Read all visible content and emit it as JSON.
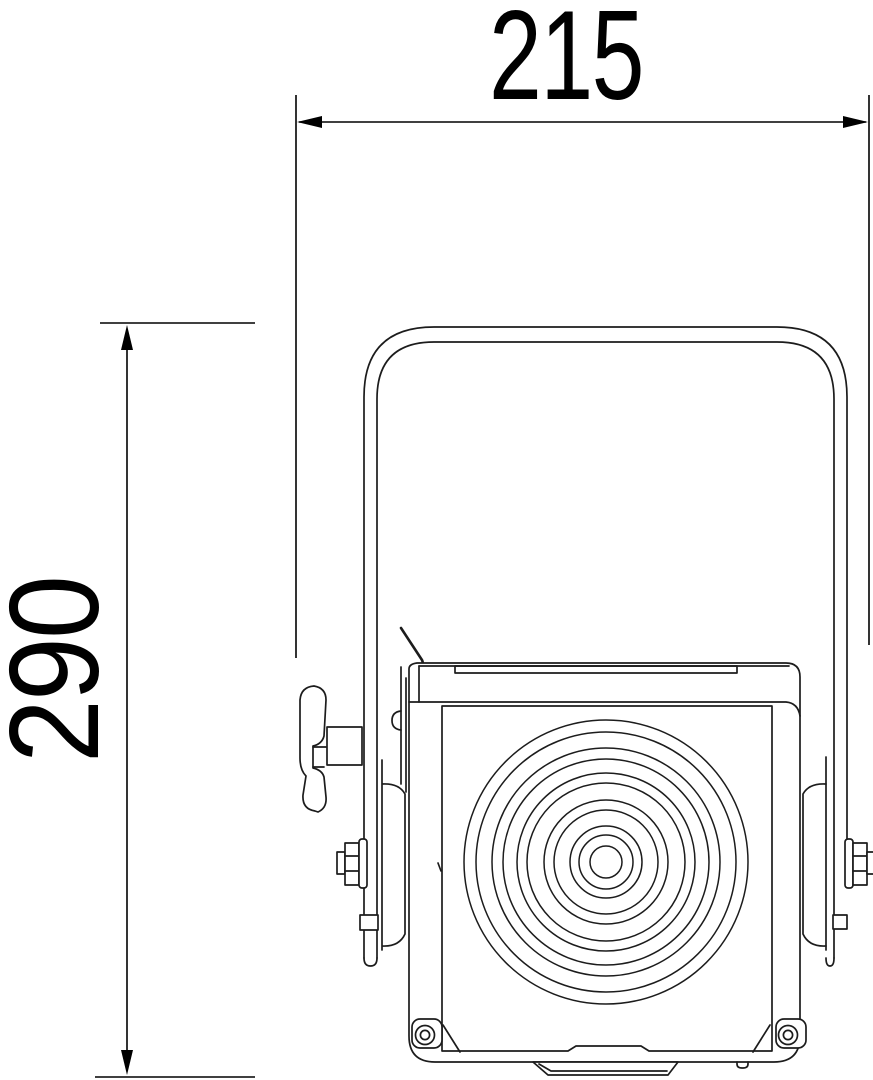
{
  "drawing": {
    "type": "technical-dimension-drawing",
    "subject": "spotlight-fixture-front-view",
    "background_color": "#ffffff",
    "line_color": "#1c1c1c",
    "dimension_color": "#000000"
  },
  "dimensions": {
    "width": {
      "label": "215"
    },
    "height": {
      "label": "290"
    }
  }
}
